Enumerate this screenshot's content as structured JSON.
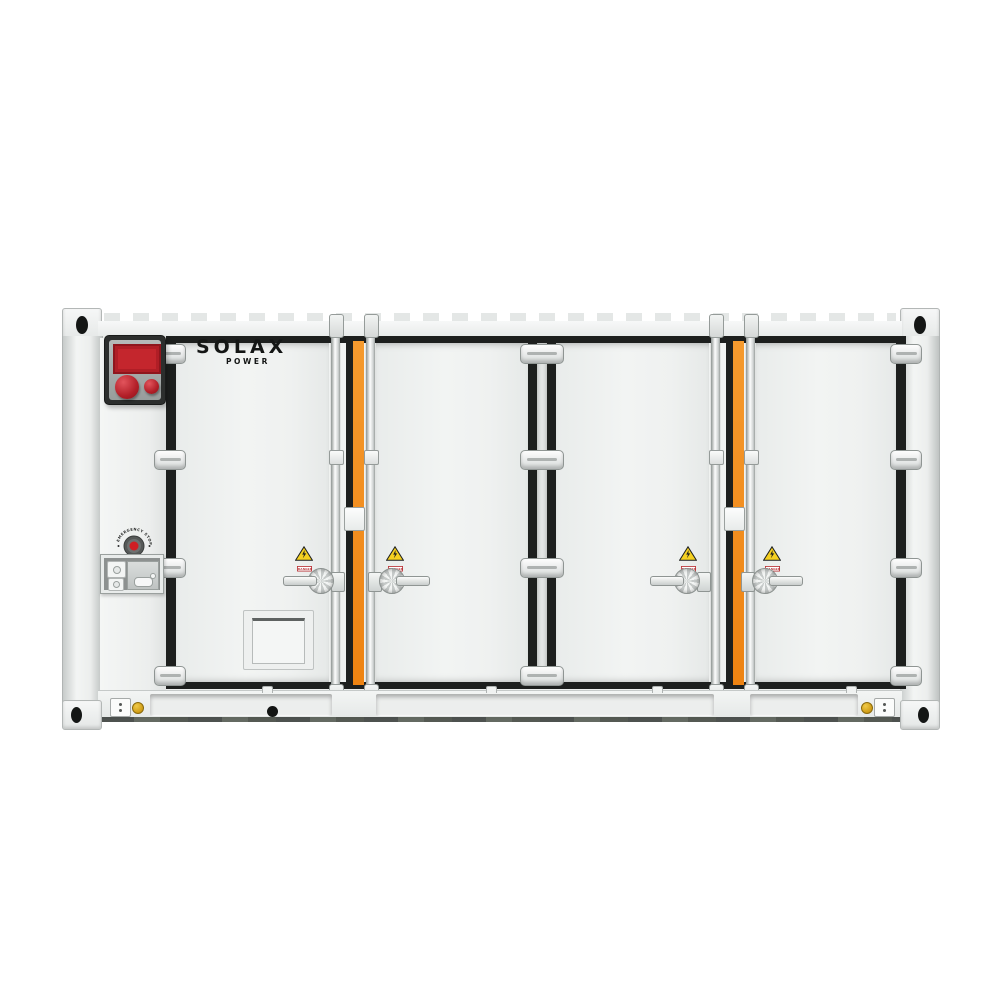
{
  "brand": {
    "name": "SOLAX",
    "sub": "POWER"
  },
  "controls": {
    "estop_label": "EMERGENCY STOP",
    "fire_panel": "fire-alarm-panel-with-display-and-two-buttons",
    "service_socket": "maintenance-socket-and-switch-box"
  },
  "warning": {
    "label": "DANGER"
  },
  "doors": {
    "count": 4,
    "names": [
      "door-1",
      "door-2",
      "door-3",
      "door-4"
    ]
  },
  "icons": {
    "high_voltage": "yellow-triangle-lightning-bolt-icon",
    "ground_badge": "gold-grounding-point-badge",
    "corner_casting": "container-corner-casting-oval-hole"
  },
  "colors": {
    "body_white": "#F0F2F1",
    "frame_black": "#1D1F1E",
    "accent_orange": "#F28A1C",
    "alarm_red": "#C4262D",
    "estop_red": "#D01F24",
    "warning_yellow": "#F5D020",
    "ground_gold": "#D7A91F",
    "background": "#FFFFFF"
  }
}
